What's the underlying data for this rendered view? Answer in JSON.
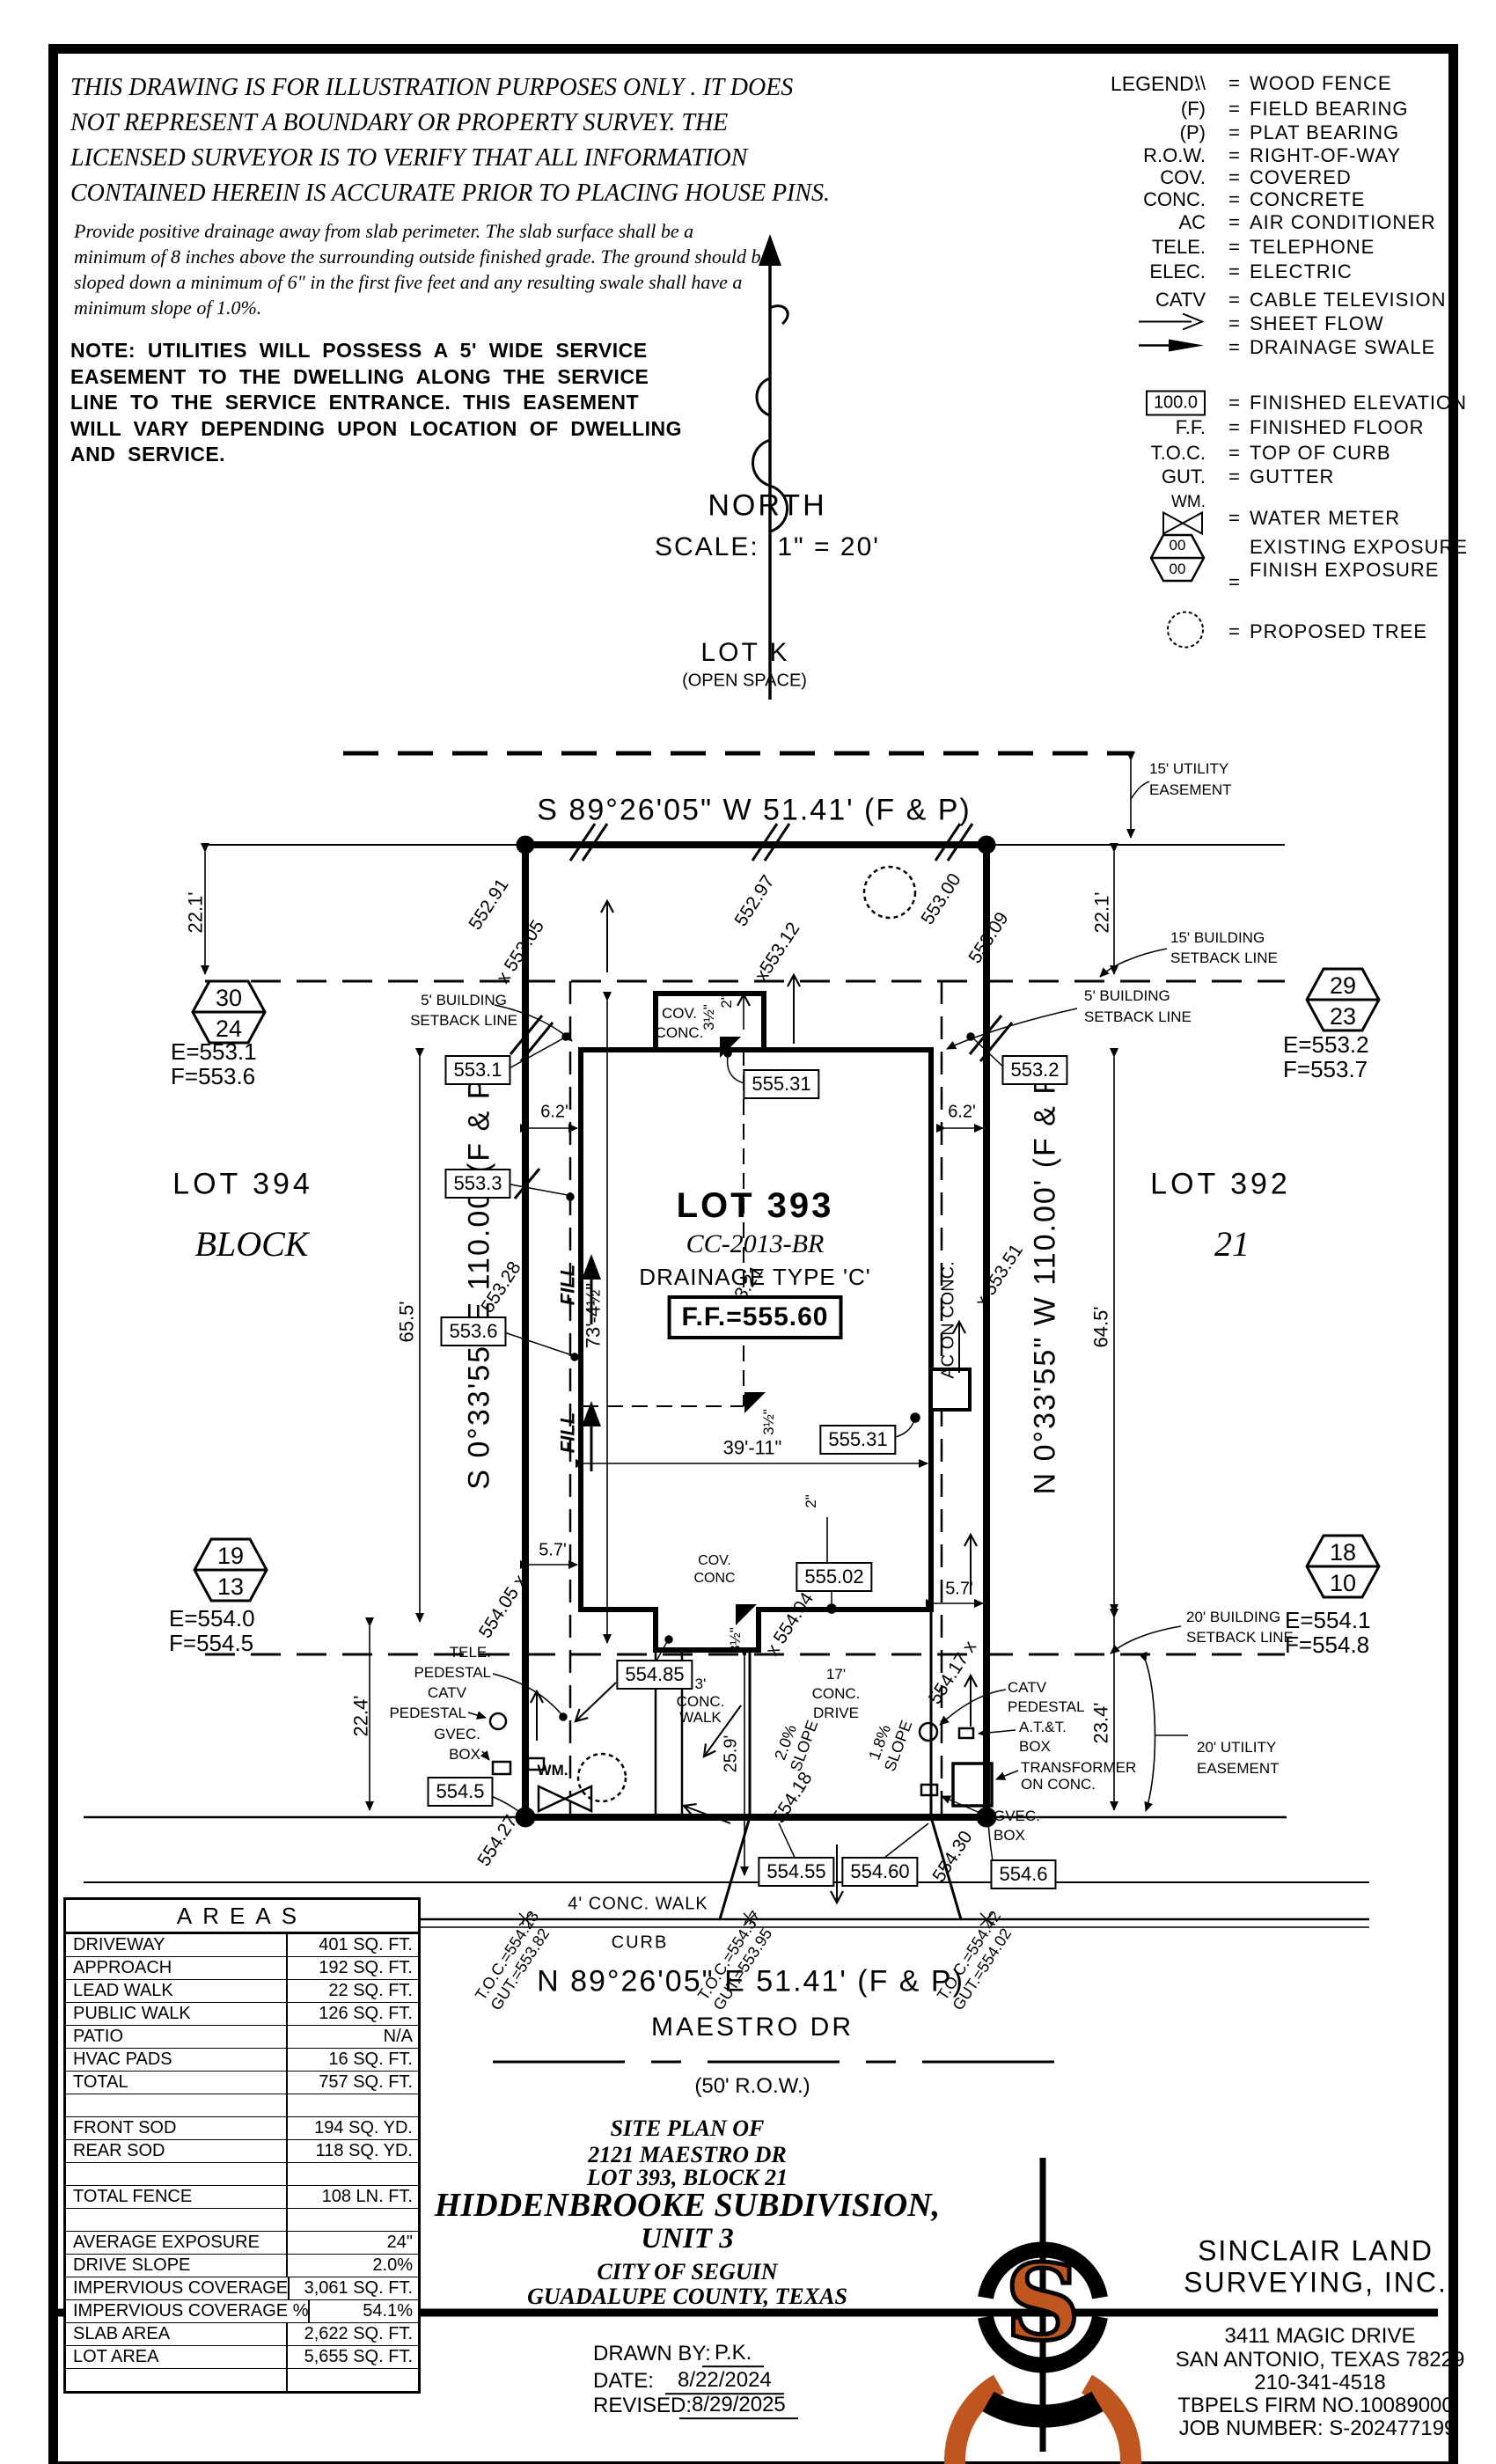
{
  "disclaimer": [
    "THIS DRAWING IS FOR ILLUSTRATION PURPOSES ONLY . IT DOES",
    "NOT REPRESENT A BOUNDARY OR PROPERTY SURVEY. THE",
    "LICENSED SURVEYOR IS TO VERIFY THAT ALL INFORMATION",
    "CONTAINED HEREIN IS ACCURATE PRIOR TO PLACING HOUSE PINS."
  ],
  "drainage_note": [
    "Provide positive drainage away from slab perimeter. The slab surface shall be a",
    "minimum of 8 inches above the surrounding outside finished grade. The ground should be",
    "sloped down a minimum of 6\" in the first five feet and any resulting swale shall have a",
    "minimum slope of 1.0%."
  ],
  "utility_note": [
    "NOTE:  UTILITIES  WILL  POSSESS  A  5'  WIDE  SERVICE",
    "EASEMENT  TO  THE  DWELLING  ALONG  THE  SERVICE",
    "LINE  TO  THE  SERVICE  ENTRANCE.  THIS  EASEMENT",
    "WILL  VARY  DEPENDING  UPON  LOCATION  OF  DWELLING",
    "AND  SERVICE."
  ],
  "legend": {
    "title": "LEGEND:",
    "eq": "=",
    "rows": [
      {
        "sym": "\\\\",
        "label": "WOOD FENCE"
      },
      {
        "sym": "(F)",
        "label": "FIELD BEARING"
      },
      {
        "sym": "(P)",
        "label": "PLAT BEARING"
      },
      {
        "sym": "R.O.W.",
        "label": "RIGHT-OF-WAY"
      },
      {
        "sym": "COV.",
        "label": "COVERED"
      },
      {
        "sym": "CONC.",
        "label": "CONCRETE"
      },
      {
        "sym": "AC",
        "label": "AIR CONDITIONER"
      },
      {
        "sym": "TELE.",
        "label": "TELEPHONE"
      },
      {
        "sym": "ELEC.",
        "label": "ELECTRIC"
      },
      {
        "sym": "CATV",
        "label": "CABLE TELEVISION"
      },
      {
        "sym": "",
        "label": "SHEET FLOW"
      },
      {
        "sym": "",
        "label": "DRAINAGE SWALE"
      },
      {
        "sym": "100.0",
        "label": "FINISHED ELEVATION"
      },
      {
        "sym": "F.F.",
        "label": "FINISHED FLOOR"
      },
      {
        "sym": "T.O.C.",
        "label": "TOP OF CURB"
      },
      {
        "sym": "GUT.",
        "label": "GUTTER"
      },
      {
        "sym": "WM.",
        "label": "WATER METER"
      },
      {
        "sym": "00",
        "sym2": "00",
        "label": "EXISTING EXPOSURE",
        "label2": "FINISH EXPOSURE"
      },
      {
        "sym": "",
        "label": "PROPOSED TREE"
      }
    ]
  },
  "compass": {
    "north": "NORTH",
    "scale": "SCALE:  1\" = 20'"
  },
  "site": {
    "lot_k": "LOT K",
    "open_space": "(OPEN SPACE)",
    "bearing_north": "S 89°26'05\" W 51.41' (F & P)",
    "bearing_south": "N 89°26'05\" E 51.41' (F & P)",
    "bearing_west": "S 0°33'55\" E 110.00' (F & P)",
    "bearing_east": "N 0°33'55\" W 110.00' (F & P)",
    "easement_15": [
      "15' UTILITY",
      "EASEMENT"
    ],
    "setback_15": [
      "15' BUILDING",
      "SETBACK LINE"
    ],
    "setback_5": [
      "5' BUILDING",
      "SETBACK LINE"
    ],
    "setback_20": [
      "20' BUILDING",
      "SETBACK LINE"
    ],
    "easement_20": [
      "20' UTILITY",
      "EASEMENT"
    ],
    "lot_394": "LOT 394",
    "block_word": "BLOCK",
    "lot_392": "LOT 392",
    "block_number": "21",
    "lot_393": "LOT 393",
    "plan_code": "CC-2013-BR",
    "drainage_type": "DRAINAGE TYPE 'C'",
    "finished_floor": "F.F.=555.60",
    "cov": "COV.",
    "conc": "CONC.",
    "conc2": "CONC",
    "ac_on_conc": "AC ON CONC.",
    "fill": "FILL",
    "dims": {
      "d22_1": "22.1'",
      "d65_5": "65.5'",
      "d64_5": "64.5'",
      "d22_4": "22.4'",
      "d23_4": "23.4'",
      "d6_2": "6.2'",
      "d5_7": "5.7'",
      "d73": "73'-4½\"",
      "d39": "39'-11\"",
      "d25_9": "25.9'",
      "d3_5": "3½\"",
      "d2": "2\""
    },
    "boxed": {
      "e553_1": "553.1",
      "e553_3": "553.3",
      "e553_6": "553.6",
      "e553_2": "553.2",
      "e555_31": "555.31",
      "e555_02": "555.02",
      "e554_85": "554.85",
      "e554_5": "554.5",
      "e554_55": "554.55",
      "e554_60": "554.60",
      "e554_6": "554.6"
    },
    "spot": {
      "s552_91": "552.91",
      "s553_05": "x 553.05",
      "s552_97": "552.97",
      "s553_12": "x553.12",
      "s553_00": "553.00",
      "s553_09": "553.09",
      "s553_28": "553.28",
      "s553_21": "553.21",
      "s553_51": "x 553.51",
      "s554_05": "554.05 x",
      "s554_04": "x 554.04",
      "s554_27": "554.27",
      "s554_17": "554.17 x",
      "s554_30": "554.30",
      "s554_18": "554.18"
    },
    "util": {
      "tele": "TELE.",
      "pedestal": "PEDESTAL",
      "catv": "CATV",
      "gvec": "GVEC.",
      "box": "BOX",
      "wm": "WM.",
      "att": "A.T.&T.",
      "transformer": "TRANSFORMER",
      "on_conc": "ON CONC."
    },
    "drive": {
      "d17": "17'",
      "conc": "CONC.",
      "drive": "DRIVE",
      "slope2": "2.0%",
      "slope18": "1.8%",
      "slope": "SLOPE",
      "w3a": "3'",
      "w3b": "CONC.",
      "w3c": "WALK",
      "walk4": "4' CONC. WALK",
      "curb": "CURB"
    },
    "toc": {
      "t1": "T.O.C.=554.23\nGUT.=553.82",
      "t2": "T.O.C.=554.37\nGUT.=553.95",
      "t3": "T.O.C.=554.42\nGUT.=554.02"
    },
    "street": {
      "name": "MAESTRO DR",
      "row": "(50' R.O.W.)"
    }
  },
  "markers": [
    {
      "n1": "30",
      "n2": "24",
      "e": "E=553.1",
      "f": "F=553.6"
    },
    {
      "n1": "29",
      "n2": "23",
      "e": "E=553.2",
      "f": "F=553.7"
    },
    {
      "n1": "19",
      "n2": "13",
      "e": "E=554.0",
      "f": "F=554.5"
    },
    {
      "n1": "18",
      "n2": "10",
      "e": "E=554.1",
      "f": "F=554.8"
    }
  ],
  "areas": {
    "title": "AREAS",
    "rows": [
      {
        "label": "DRIVEWAY",
        "value": "401 SQ. FT."
      },
      {
        "label": "APPROACH",
        "value": "192 SQ. FT."
      },
      {
        "label": "LEAD WALK",
        "value": "22 SQ. FT."
      },
      {
        "label": "PUBLIC WALK",
        "value": "126 SQ. FT."
      },
      {
        "label": "PATIO",
        "value": "N/A"
      },
      {
        "label": "HVAC PADS",
        "value": "16 SQ. FT."
      },
      {
        "label": "TOTAL",
        "value": "757 SQ. FT."
      },
      {
        "label": "",
        "value": ""
      },
      {
        "label": "FRONT SOD",
        "value": "194 SQ. YD."
      },
      {
        "label": "REAR SOD",
        "value": "118 SQ. YD."
      },
      {
        "label": "",
        "value": ""
      },
      {
        "label": "TOTAL FENCE",
        "value": "108 LN. FT."
      },
      {
        "label": "",
        "value": ""
      },
      {
        "label": "AVERAGE EXPOSURE",
        "value": "24\""
      },
      {
        "label": "DRIVE SLOPE",
        "value": "2.0%"
      },
      {
        "label": "IMPERVIOUS COVERAGE",
        "value": "3,061 SQ. FT."
      },
      {
        "label": "IMPERVIOUS COVERAGE %",
        "value": "54.1%"
      },
      {
        "label": "SLAB AREA",
        "value": "2,622 SQ. FT."
      },
      {
        "label": "LOT AREA",
        "value": "5,655 SQ. FT."
      },
      {
        "label": "",
        "value": ""
      }
    ]
  },
  "title_block": {
    "l1": "SITE PLAN OF",
    "l2": "2121 MAESTRO DR",
    "l3": "LOT 393, BLOCK 21",
    "l4": "HIDDENBROOKE SUBDIVISION,",
    "l5": "UNIT 3",
    "l6": "CITY OF SEGUIN",
    "l7": "GUADALUPE COUNTY, TEXAS",
    "drawn_by_label": "DRAWN BY:",
    "drawn_by": "P.K.",
    "date_label": "DATE:",
    "date": "8/22/2024",
    "revised_label": "REVISED:",
    "revised": "8/29/2025"
  },
  "firm": {
    "logo_letter": "S",
    "name1": "SINCLAIR LAND",
    "name2": "SURVEYING, INC.",
    "addr1": "3411 MAGIC DRIVE",
    "addr2": "SAN ANTONIO, TEXAS 78229",
    "phone": "210-341-4518",
    "tbpels": "TBPELS FIRM NO.10089000",
    "job": "JOB NUMBER: S-202477199"
  },
  "colors": {
    "logo_orange": "#c0561f",
    "line_black": "#000000"
  }
}
